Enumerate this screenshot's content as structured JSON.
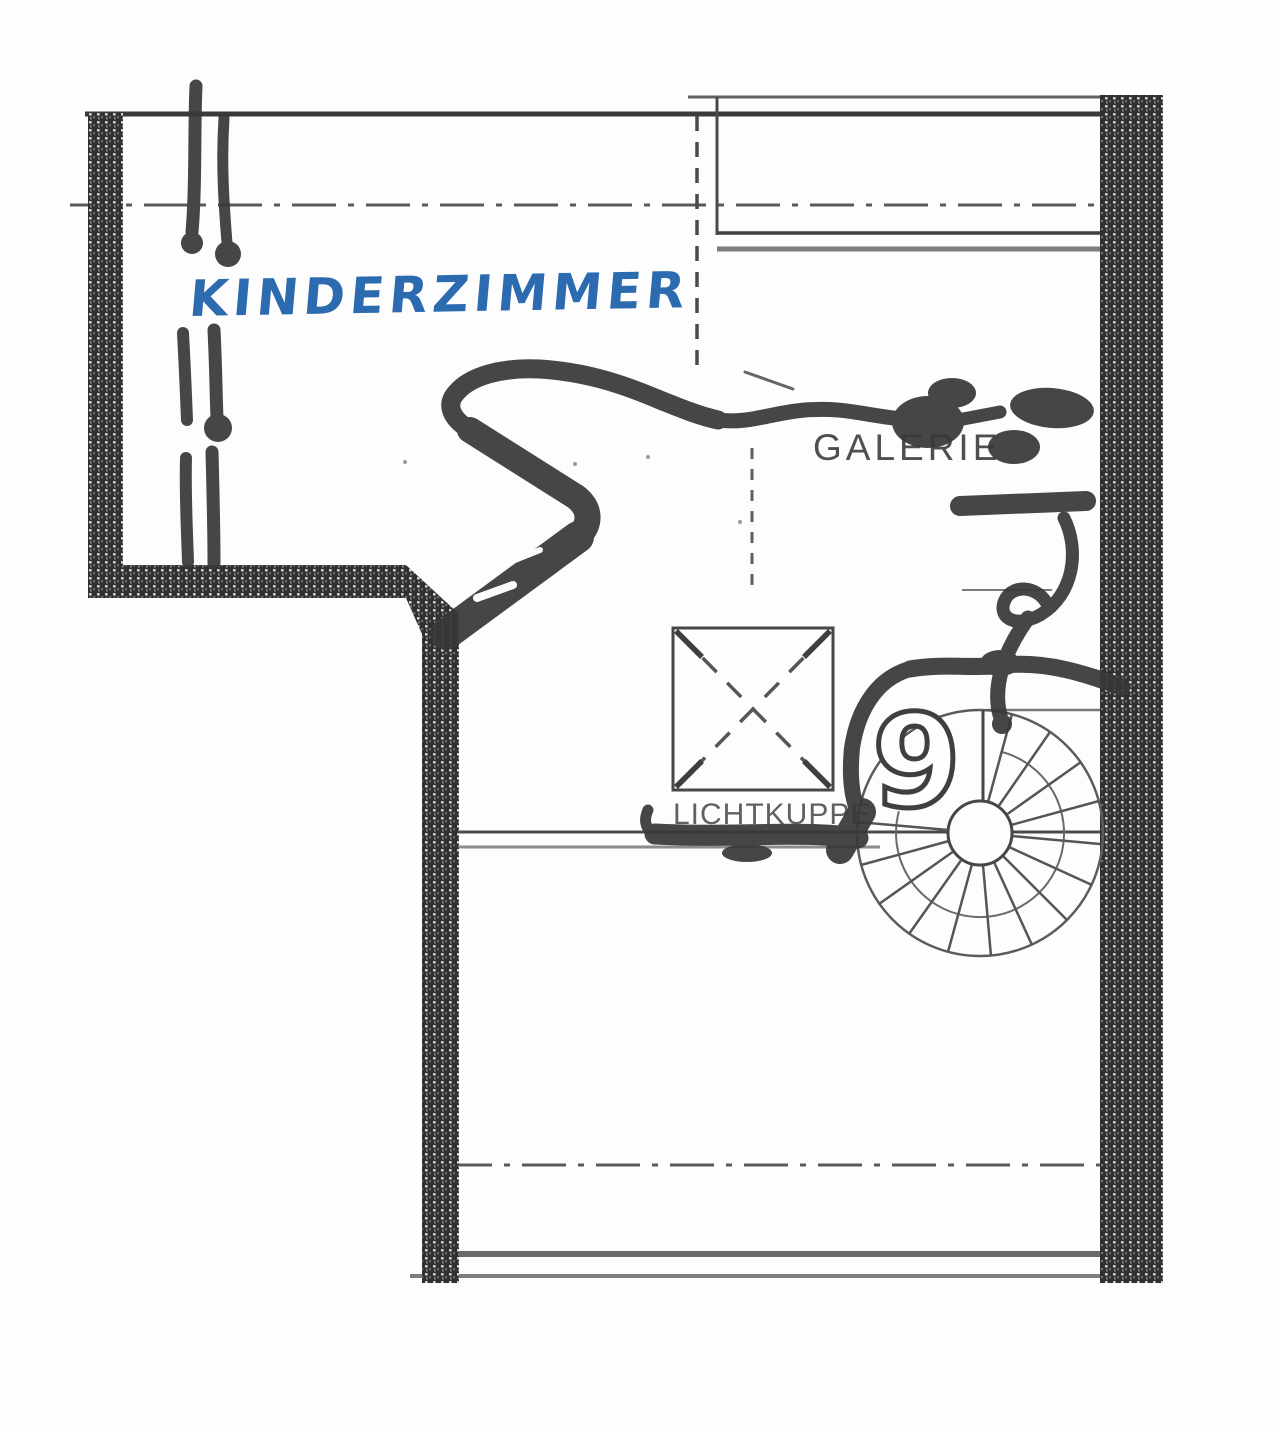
{
  "floor_plan": {
    "handwritten": {
      "room_label": "KINDERZIMMER",
      "ink_color": "#2d6bb0",
      "marker_color": "#383838"
    },
    "printed": {
      "gallery_label": "GALERIE",
      "skylight_label": "LICHTKUPPE",
      "stair_number": "9"
    },
    "elements": {
      "stair": "spiral-staircase",
      "skylight": "skylight-square-with-dashed-diagonals",
      "walls": "hatched-masonry-walls",
      "axis_lines": "dash-dot-center-lines"
    },
    "colors": {
      "paper": "#fdfdfd",
      "print_line_dark": "#4a4a4a",
      "print_line_grey": "#7d7d7d",
      "wall_fill": "#303030",
      "annotation_blue": "#2d6bb0",
      "annotation_marker": "#383838"
    }
  }
}
